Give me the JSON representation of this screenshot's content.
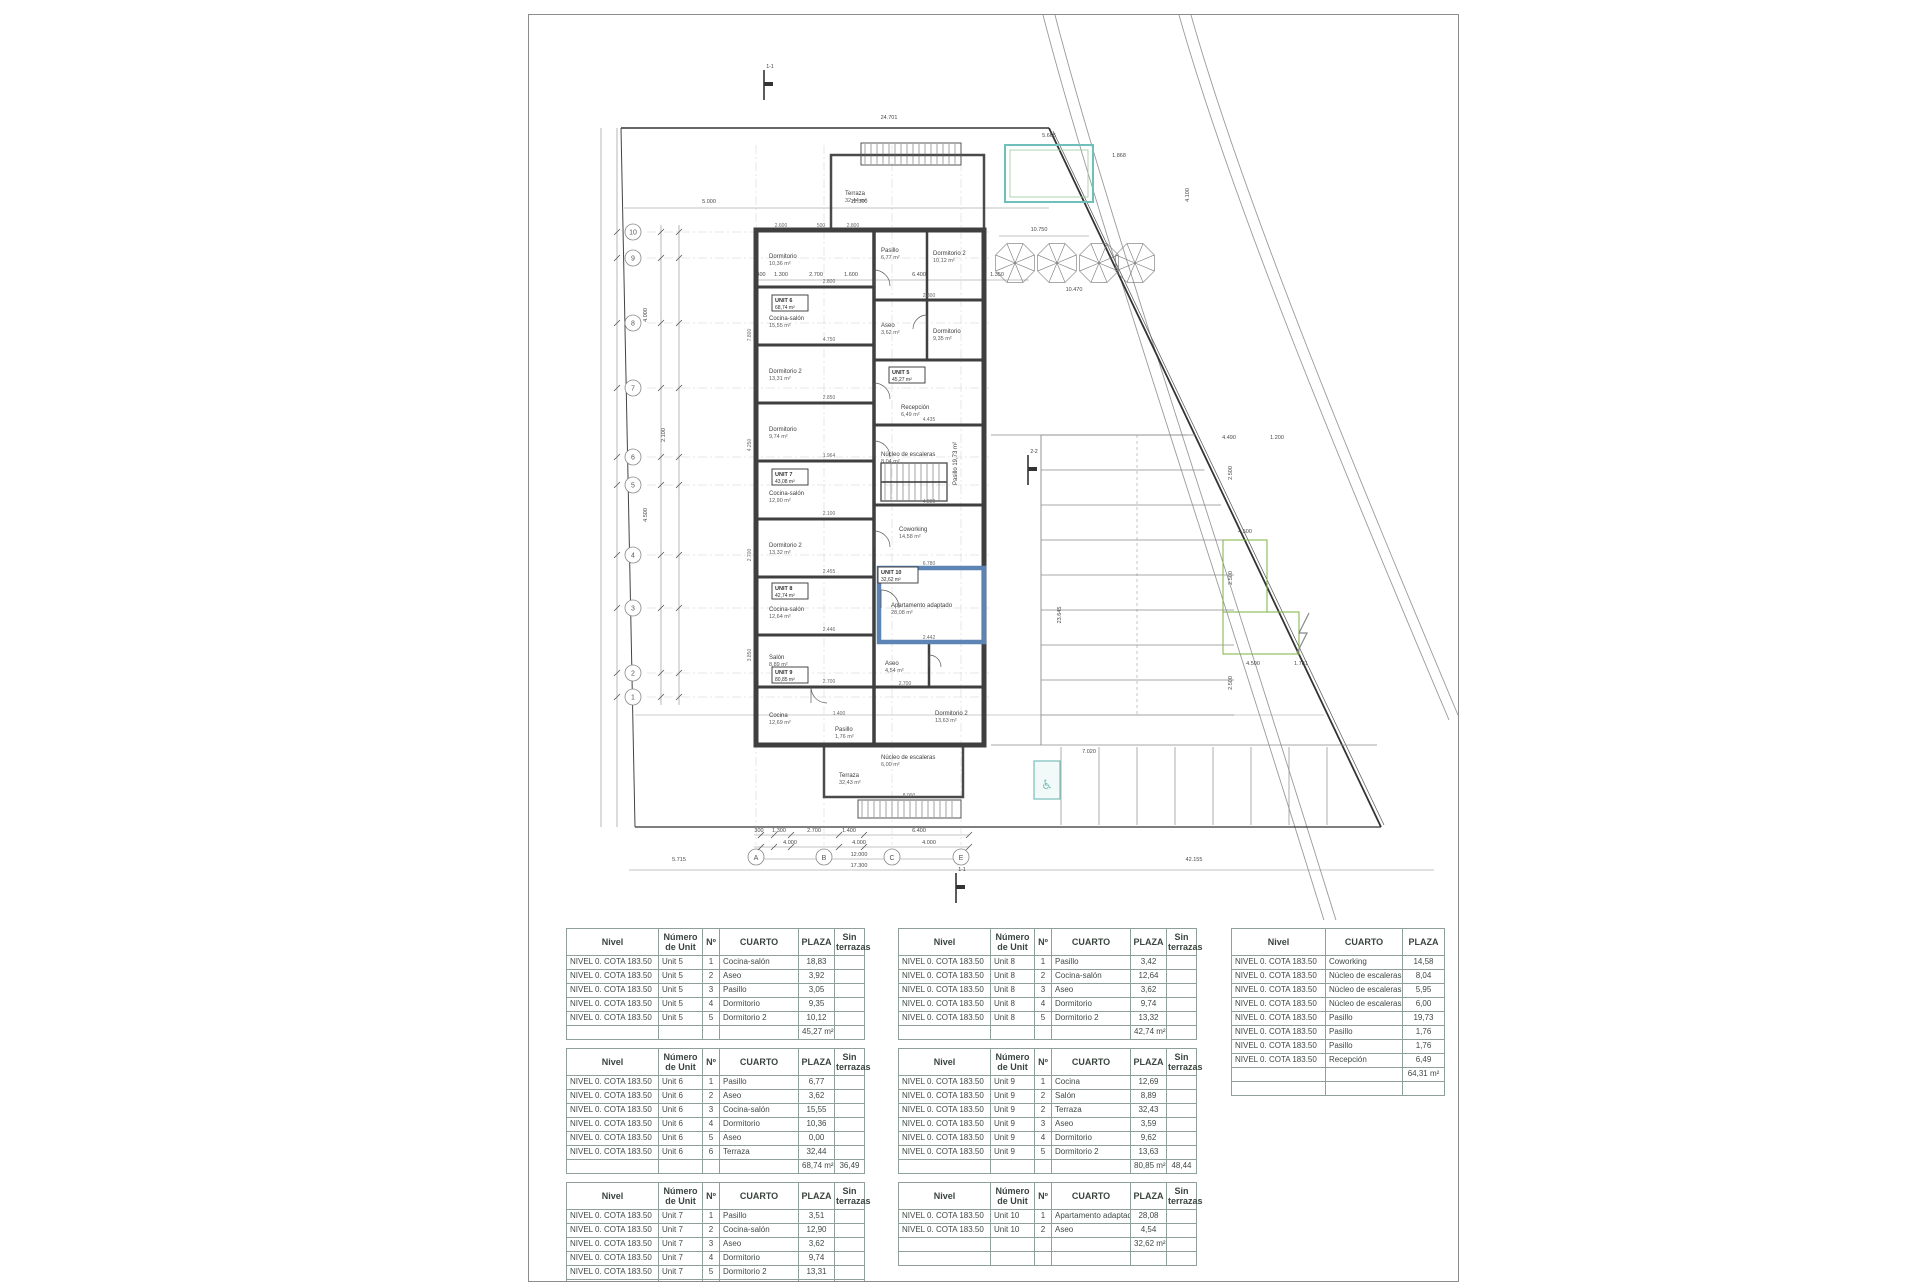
{
  "sheet": {
    "type": "architectural-floor-plan"
  },
  "plan": {
    "grid": {
      "rows": [
        {
          "label": "10",
          "y": 217
        },
        {
          "label": "9",
          "y": 243
        },
        {
          "label": "8",
          "y": 308
        },
        {
          "label": "7",
          "y": 373
        },
        {
          "label": "6",
          "y": 442
        },
        {
          "label": "5",
          "y": 470
        },
        {
          "label": "4",
          "y": 540
        },
        {
          "label": "3",
          "y": 593
        },
        {
          "label": "2",
          "y": 658
        },
        {
          "label": "1",
          "y": 682
        }
      ],
      "cols": [
        {
          "label": "A",
          "x": 227
        },
        {
          "label": "B",
          "x": 295
        },
        {
          "label": "C",
          "x": 363
        },
        {
          "label": "E",
          "x": 432
        }
      ]
    },
    "rooms": [
      {
        "name": "Terraza",
        "area": "32,44 m²",
        "x": 316,
        "y": 180
      },
      {
        "name": "Dormitorio",
        "area": "10,36 m²",
        "x": 240,
        "y": 243
      },
      {
        "name": "Cocina-salón",
        "area": "15,55 m²",
        "x": 240,
        "y": 305
      },
      {
        "name": "Dormitorio 2",
        "area": "13,31 m²",
        "x": 240,
        "y": 358
      },
      {
        "name": "Dormitorio",
        "area": "9,74 m²",
        "x": 240,
        "y": 416
      },
      {
        "name": "Cocina-salón",
        "area": "12,90 m²",
        "x": 240,
        "y": 480
      },
      {
        "name": "Dormitorio 2",
        "area": "13,32 m²",
        "x": 240,
        "y": 532
      },
      {
        "name": "Cocina-salón",
        "area": "12,64 m²",
        "x": 240,
        "y": 596
      },
      {
        "name": "Salón",
        "area": "8,89 m²",
        "x": 240,
        "y": 644
      },
      {
        "name": "Cocina",
        "area": "12,69 m²",
        "x": 240,
        "y": 702
      },
      {
        "name": "Pasillo",
        "area": "6,77 m²",
        "x": 352,
        "y": 237
      },
      {
        "name": "Dormitorio 2",
        "area": "10,12 m²",
        "x": 404,
        "y": 240
      },
      {
        "name": "Aseo",
        "area": "3,62 m²",
        "x": 352,
        "y": 312
      },
      {
        "name": "Dormitorio",
        "area": "9,35 m²",
        "x": 404,
        "y": 318
      },
      {
        "name": "Recepción",
        "area": "6,49 m²",
        "x": 372,
        "y": 394
      },
      {
        "name": "Núcleo de escaleras",
        "area": "8,04 m²",
        "x": 352,
        "y": 441
      },
      {
        "name": "Pasillo 19,73 m²",
        "area": "",
        "x": 428,
        "y": 470,
        "rot": -90
      },
      {
        "name": "Coworking",
        "area": "14,58 m²",
        "x": 370,
        "y": 516
      },
      {
        "name": "Apartamento adaptado",
        "area": "28,08 m²",
        "x": 362,
        "y": 592
      },
      {
        "name": "Aseo",
        "area": "4,54 m²",
        "x": 356,
        "y": 650
      },
      {
        "name": "Dormitorio 2",
        "area": "13,63 m²",
        "x": 406,
        "y": 700
      },
      {
        "name": "Pasillo",
        "area": "1,76 m²",
        "x": 306,
        "y": 716
      },
      {
        "name": "Núcleo de escaleras",
        "area": "6,00 m²",
        "x": 352,
        "y": 744
      },
      {
        "name": "Terraza",
        "area": "32,43 m²",
        "x": 310,
        "y": 762
      }
    ],
    "unit_boxes": [
      {
        "label": "UNIT 5",
        "total": "45,27 m²",
        "x": 363,
        "y": 360
      },
      {
        "label": "UNIT 6",
        "total": "68,74 m²",
        "x": 246,
        "y": 288
      },
      {
        "label": "UNIT 7",
        "total": "43,08 m²",
        "x": 246,
        "y": 462
      },
      {
        "label": "UNIT 8",
        "total": "42,74 m²",
        "x": 246,
        "y": 576
      },
      {
        "label": "UNIT 9",
        "total": "80,85 m²",
        "x": 246,
        "y": 660
      },
      {
        "label": "UNIT 10",
        "total": "32,62 m²",
        "x": 352,
        "y": 560
      }
    ],
    "dims": [
      {
        "t": "24.701",
        "x": 360,
        "y": 104
      },
      {
        "t": "5.000",
        "x": 180,
        "y": 188
      },
      {
        "t": "12.300",
        "x": 330,
        "y": 188
      },
      {
        "t": "10.750",
        "x": 510,
        "y": 216
      },
      {
        "t": "10.470",
        "x": 545,
        "y": 276
      },
      {
        "t": "300",
        "x": 232,
        "y": 261
      },
      {
        "t": "1.300",
        "x": 252,
        "y": 261
      },
      {
        "t": "2.700",
        "x": 287,
        "y": 261
      },
      {
        "t": "1.600",
        "x": 322,
        "y": 261
      },
      {
        "t": "6.400",
        "x": 390,
        "y": 261
      },
      {
        "t": "1.350",
        "x": 468,
        "y": 261
      },
      {
        "t": "5.665",
        "x": 520,
        "y": 122
      },
      {
        "t": "1.868",
        "x": 590,
        "y": 142
      },
      {
        "t": "4.490",
        "x": 700,
        "y": 424
      },
      {
        "t": "1.200",
        "x": 748,
        "y": 424
      },
      {
        "t": "4.500",
        "x": 716,
        "y": 518
      },
      {
        "t": "4.500",
        "x": 724,
        "y": 650
      },
      {
        "t": "1.781",
        "x": 772,
        "y": 650
      },
      {
        "t": "7.020",
        "x": 560,
        "y": 738
      },
      {
        "t": "300",
        "x": 230,
        "y": 817
      },
      {
        "t": "1.300",
        "x": 250,
        "y": 817
      },
      {
        "t": "2.700",
        "x": 285,
        "y": 817
      },
      {
        "t": "1.400",
        "x": 320,
        "y": 817
      },
      {
        "t": "6.400",
        "x": 390,
        "y": 817
      },
      {
        "t": "4.000",
        "x": 261,
        "y": 829
      },
      {
        "t": "4.000",
        "x": 330,
        "y": 829
      },
      {
        "t": "4.000",
        "x": 400,
        "y": 829
      },
      {
        "t": "12.000",
        "x": 330,
        "y": 841
      },
      {
        "t": "17.300",
        "x": 330,
        "y": 852
      },
      {
        "t": "5.715",
        "x": 150,
        "y": 846
      },
      {
        "t": "42.155",
        "x": 665,
        "y": 846
      },
      {
        "t": "4.000",
        "x": 118,
        "y": 300,
        "rot": -90
      },
      {
        "t": "4.500",
        "x": 118,
        "y": 500,
        "rot": -90
      },
      {
        "t": "2.100",
        "x": 136,
        "y": 420,
        "rot": -90
      },
      {
        "t": "23.645",
        "x": 532,
        "y": 600,
        "rot": -90
      },
      {
        "t": "2.500",
        "x": 703,
        "y": 458,
        "rot": -90
      },
      {
        "t": "2.500",
        "x": 703,
        "y": 563,
        "rot": -90
      },
      {
        "t": "2.500",
        "x": 703,
        "y": 668,
        "rot": -90
      },
      {
        "t": "4.100",
        "x": 660,
        "y": 180,
        "rot": -90
      }
    ],
    "micro_dims": [
      {
        "t": "2.600",
        "x": 252,
        "y": 212
      },
      {
        "t": "500",
        "x": 292,
        "y": 212
      },
      {
        "t": "2.800",
        "x": 324,
        "y": 212
      },
      {
        "t": "7.800",
        "x": 222,
        "y": 320,
        "rot": -90
      },
      {
        "t": "4.250",
        "x": 222,
        "y": 430,
        "rot": -90
      },
      {
        "t": "2.700",
        "x": 222,
        "y": 540,
        "rot": -90
      },
      {
        "t": "3.850",
        "x": 222,
        "y": 640,
        "rot": -90
      },
      {
        "t": "2.800",
        "x": 300,
        "y": 268
      },
      {
        "t": "4.750",
        "x": 300,
        "y": 326
      },
      {
        "t": "2.850",
        "x": 300,
        "y": 384
      },
      {
        "t": "1.964",
        "x": 300,
        "y": 442
      },
      {
        "t": "2.100",
        "x": 300,
        "y": 500
      },
      {
        "t": "2.455",
        "x": 300,
        "y": 558
      },
      {
        "t": "2.446",
        "x": 300,
        "y": 616
      },
      {
        "t": "2.700",
        "x": 300,
        "y": 668
      },
      {
        "t": "2.800",
        "x": 400,
        "y": 282
      },
      {
        "t": "4.435",
        "x": 400,
        "y": 406
      },
      {
        "t": "4.800",
        "x": 400,
        "y": 488
      },
      {
        "t": "6.780",
        "x": 400,
        "y": 550
      },
      {
        "t": "2.442",
        "x": 400,
        "y": 624
      },
      {
        "t": "2.700",
        "x": 376,
        "y": 670
      },
      {
        "t": "8.000",
        "x": 380,
        "y": 782
      },
      {
        "t": "1.400",
        "x": 310,
        "y": 700
      }
    ],
    "section_markers": [
      {
        "label": "1-1",
        "x": 235,
        "y": 55
      },
      {
        "label": "2-2",
        "x": 499,
        "y": 440
      },
      {
        "label": "1-1",
        "x": 427,
        "y": 858
      }
    ],
    "colors": {
      "wall": "#3f3f3f",
      "highlight_wall": "#5c85b5",
      "pool": "#6fc0ba",
      "pool_inner": "#9ccc9c",
      "green_area": "#7cb342",
      "accessible": "#79bfb9",
      "road": "#999999",
      "boundary": "#333333"
    }
  },
  "tables": {
    "headers": [
      "Nivel",
      "Número de Unit",
      "Nº",
      "CUARTO",
      "PLAZA",
      "Sin terrazas"
    ],
    "common_headers": [
      "Nivel",
      "CUARTO",
      "PLAZA"
    ],
    "nivel": "NIVEL 0. COTA 183.50",
    "unit_tables": [
      {
        "col": 1,
        "unit": "Unit 5",
        "rooms": [
          {
            "n": "1",
            "cuarto": "Cocina-salón",
            "plaza": "18,83"
          },
          {
            "n": "2",
            "cuarto": "Aseo",
            "plaza": "3,92"
          },
          {
            "n": "3",
            "cuarto": "Pasillo",
            "plaza": "3,05"
          },
          {
            "n": "4",
            "cuarto": "Dormitorio",
            "plaza": "9,35"
          },
          {
            "n": "5",
            "cuarto": "Dormitorio 2",
            "plaza": "10,12"
          }
        ],
        "total": "45,27 m²",
        "total_sin": "",
        "trailing_empty": false
      },
      {
        "col": 1,
        "unit": "Unit 6",
        "rooms": [
          {
            "n": "1",
            "cuarto": "Pasillo",
            "plaza": "6,77"
          },
          {
            "n": "2",
            "cuarto": "Aseo",
            "plaza": "3,62"
          },
          {
            "n": "3",
            "cuarto": "Cocina-salón",
            "plaza": "15,55"
          },
          {
            "n": "4",
            "cuarto": "Dormitorio",
            "plaza": "10,36"
          },
          {
            "n": "5",
            "cuarto": "Aseo",
            "plaza": "0,00"
          },
          {
            "n": "6",
            "cuarto": "Terraza",
            "plaza": "32,44"
          }
        ],
        "total": "68,74 m²",
        "total_sin": "36,49",
        "trailing_empty": false
      },
      {
        "col": 1,
        "unit": "Unit 7",
        "rooms": [
          {
            "n": "1",
            "cuarto": "Pasillo",
            "plaza": "3,51"
          },
          {
            "n": "2",
            "cuarto": "Cocina-salón",
            "plaza": "12,90"
          },
          {
            "n": "3",
            "cuarto": "Aseo",
            "plaza": "3,62"
          },
          {
            "n": "4",
            "cuarto": "Dormitorio",
            "plaza": "9,74"
          },
          {
            "n": "5",
            "cuarto": "Dormitorio 2",
            "plaza": "13,31"
          }
        ],
        "total": "43,08 m²",
        "total_sin": "",
        "trailing_empty": true
      },
      {
        "col": 2,
        "unit": "Unit 8",
        "rooms": [
          {
            "n": "1",
            "cuarto": "Pasillo",
            "plaza": "3,42"
          },
          {
            "n": "2",
            "cuarto": "Cocina-salón",
            "plaza": "12,64"
          },
          {
            "n": "3",
            "cuarto": "Aseo",
            "plaza": "3,62"
          },
          {
            "n": "4",
            "cuarto": "Dormitorio",
            "plaza": "9,74"
          },
          {
            "n": "5",
            "cuarto": "Dormitorio 2",
            "plaza": "13,32"
          }
        ],
        "total": "42,74 m²",
        "total_sin": "",
        "trailing_empty": false
      },
      {
        "col": 2,
        "unit": "Unit 9",
        "rooms": [
          {
            "n": "1",
            "cuarto": "Cocina",
            "plaza": "12,69"
          },
          {
            "n": "2",
            "cuarto": "Salón",
            "plaza": "8,89"
          },
          {
            "n": "2",
            "cuarto": "Terraza",
            "plaza": "32,43"
          },
          {
            "n": "3",
            "cuarto": "Aseo",
            "plaza": "3,59"
          },
          {
            "n": "4",
            "cuarto": "Dormitorio",
            "plaza": "9,62"
          },
          {
            "n": "5",
            "cuarto": "Dormitorio 2",
            "plaza": "13,63"
          }
        ],
        "total": "80,85 m²",
        "total_sin": "48,44",
        "trailing_empty": false
      },
      {
        "col": 2,
        "unit": "Unit 10",
        "rooms": [
          {
            "n": "1",
            "cuarto": "Apartamento adaptado",
            "plaza": "28,08"
          },
          {
            "n": "2",
            "cuarto": "Aseo",
            "plaza": "4,54"
          }
        ],
        "total": "32,62 m²",
        "total_sin": "",
        "trailing_empty": true
      }
    ],
    "common_table": {
      "col": 3,
      "rows": [
        {
          "cuarto": "Coworking",
          "plaza": "14,58"
        },
        {
          "cuarto": "Núcleo de escaleras.",
          "plaza": "8,04"
        },
        {
          "cuarto": "Núcleo de escaleras.",
          "plaza": "5,95"
        },
        {
          "cuarto": "Núcleo de escaleras.",
          "plaza": "6,00"
        },
        {
          "cuarto": "Pasillo",
          "plaza": "19,73"
        },
        {
          "cuarto": "Pasillo",
          "plaza": "1,76"
        },
        {
          "cuarto": "Pasillo",
          "plaza": "1,76"
        },
        {
          "cuarto": "Recepción",
          "plaza": "6,49"
        }
      ],
      "total": "64,31 m²",
      "trailing_empty": true
    }
  }
}
